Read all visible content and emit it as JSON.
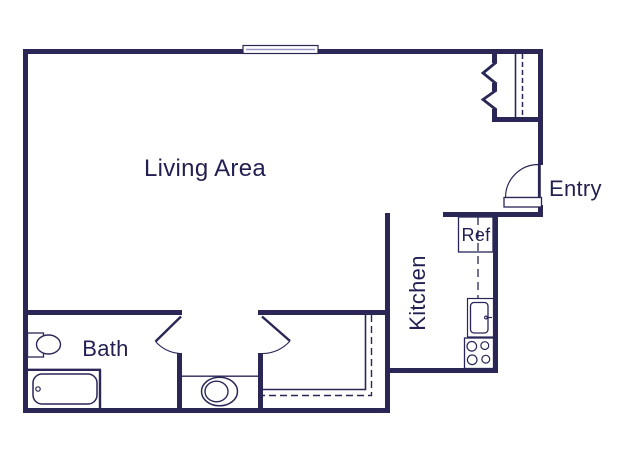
{
  "plan_title": "studio-apartment-floor-plan",
  "labels": {
    "living_area": "Living Area",
    "entry": "Entry",
    "kitchen": "Kitchen",
    "bath": "Bath",
    "refrigerator": "Ref"
  },
  "fixtures": [
    "window",
    "entry-door",
    "entry-closet-chevrons",
    "refrigerator",
    "kitchen-counter-dashline",
    "kitchen-sink",
    "stove",
    "bathroom-sink",
    "bathtub",
    "toilet",
    "bath-door",
    "closet-door",
    "closet-shelf-lines"
  ],
  "colors": {
    "wall": "#2a2757",
    "label_text": "#221f51",
    "window_line": "#9a98c4",
    "background": "#ffffff"
  }
}
